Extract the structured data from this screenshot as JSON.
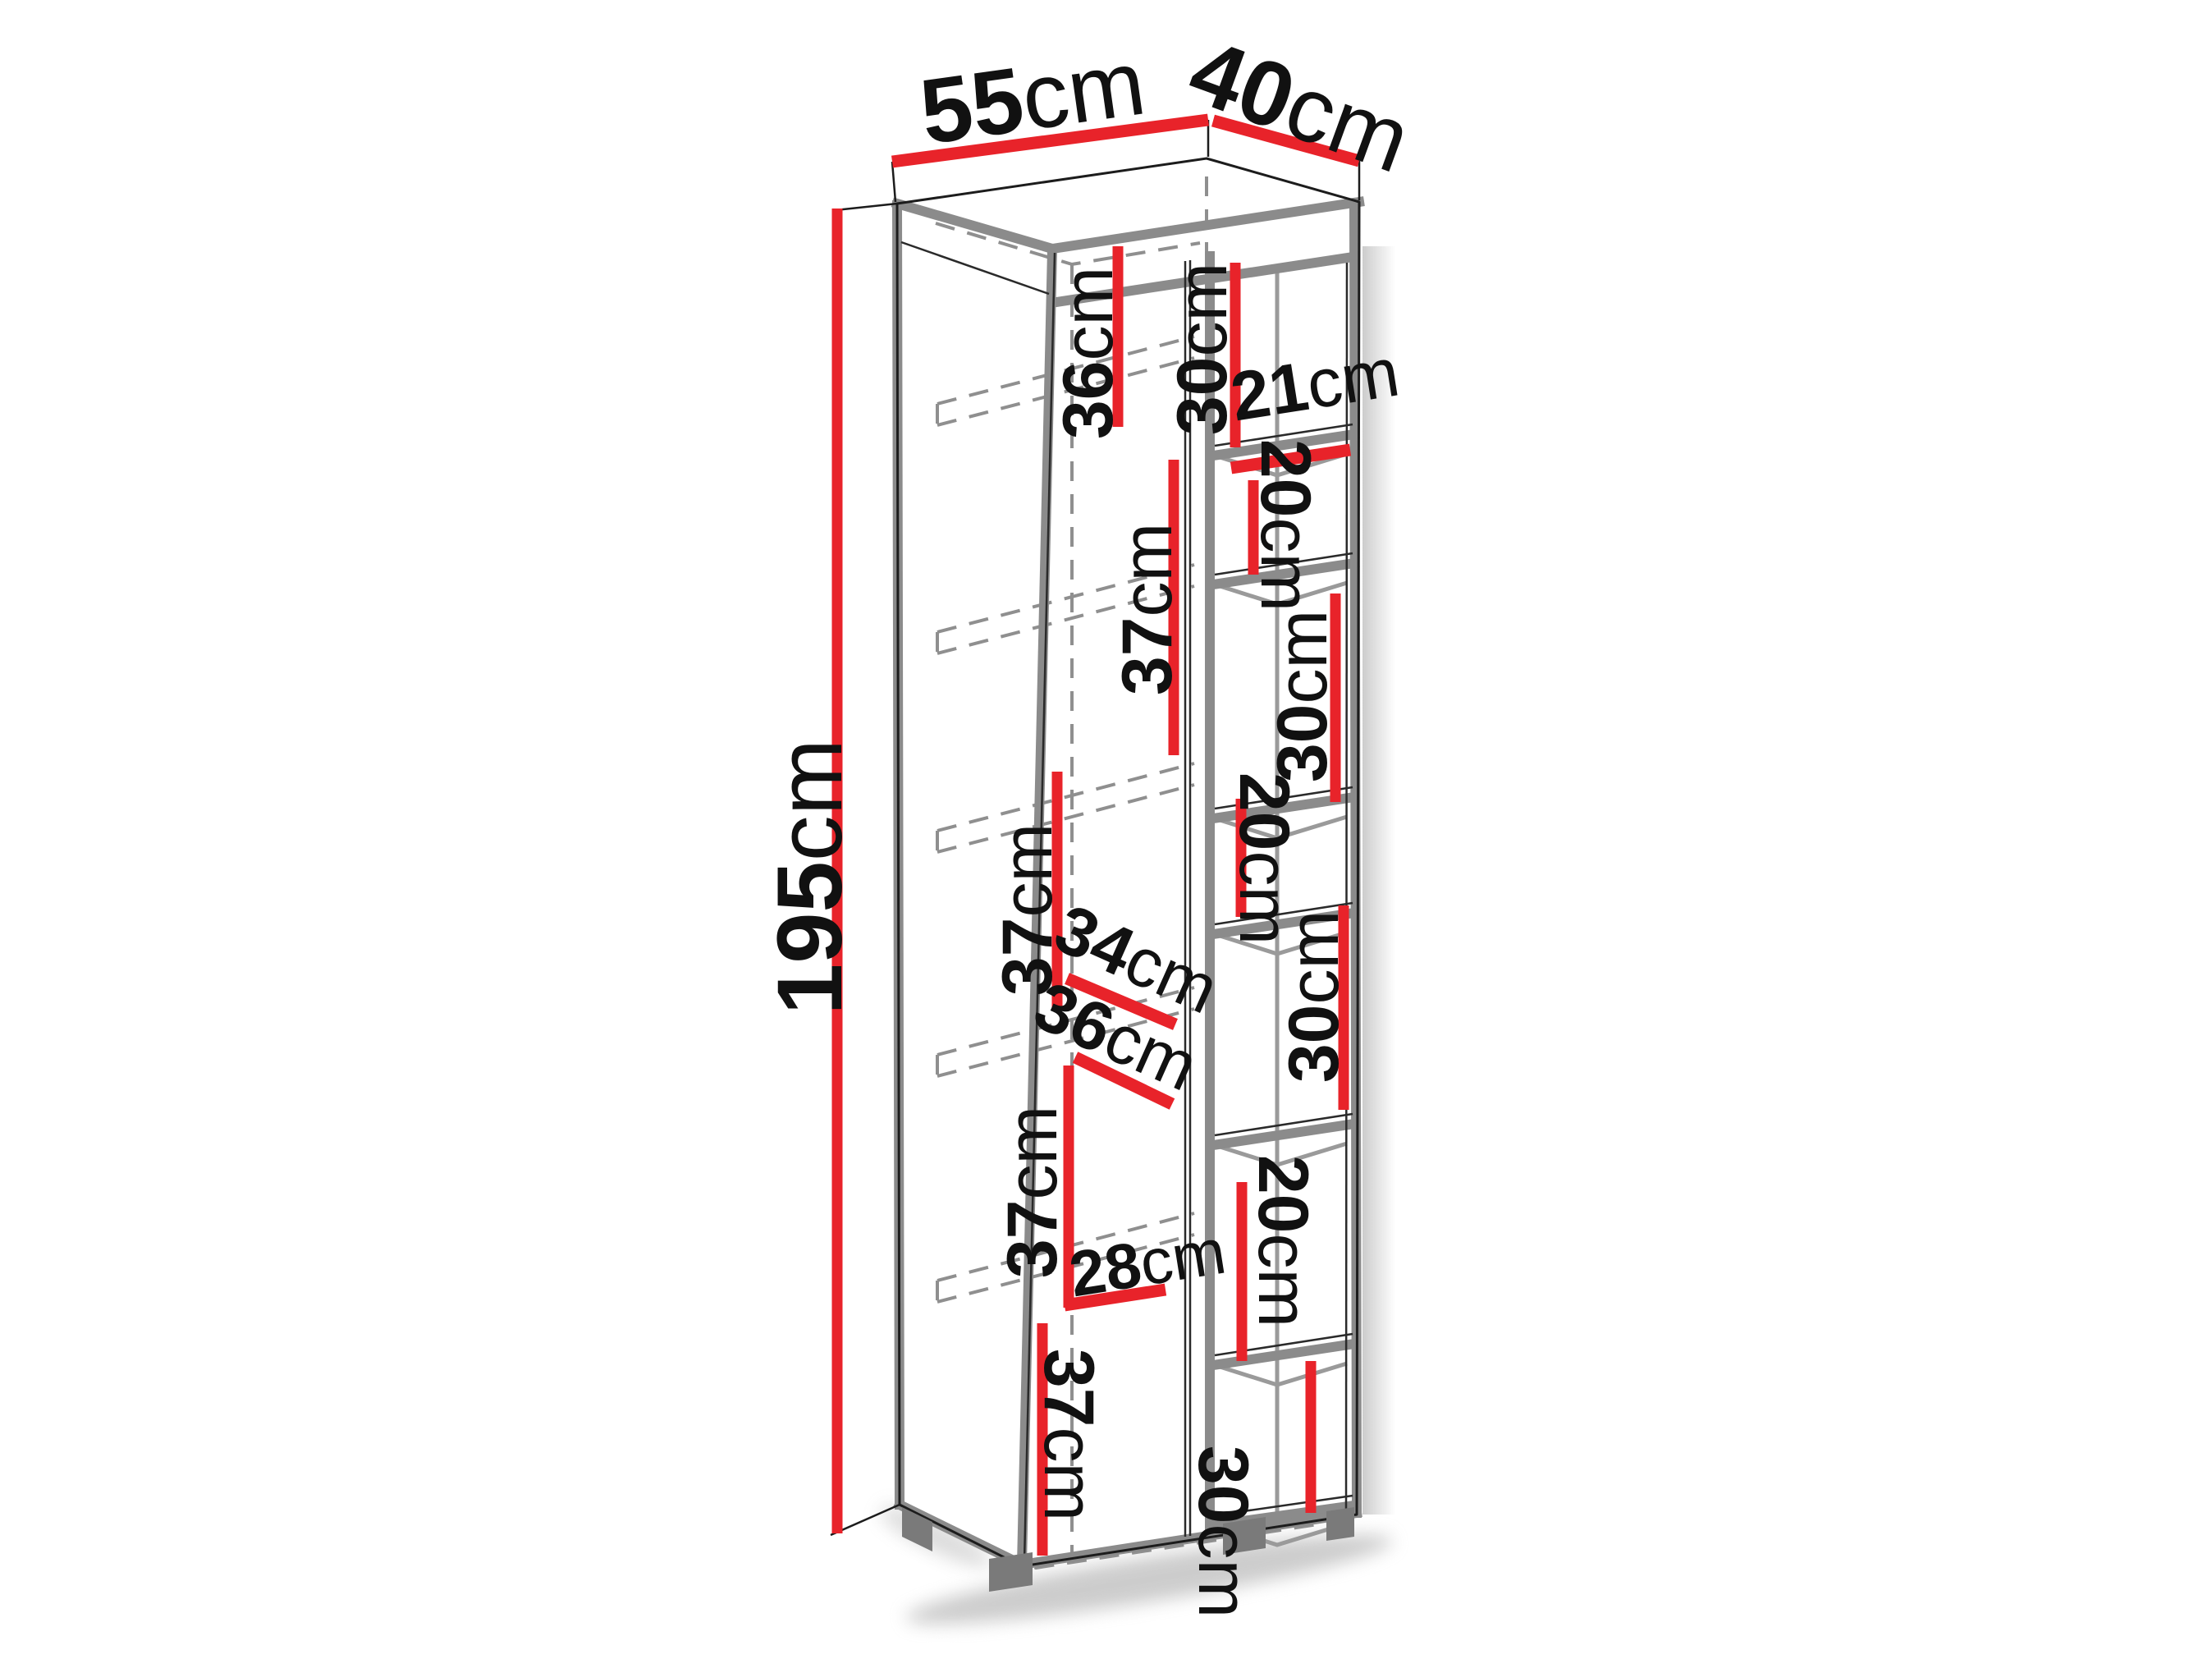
{
  "diagram": {
    "type": "furniture-dimension-drawing",
    "item": "tall-cabinet-with-open-side-shelves",
    "unit": "cm",
    "overall": {
      "width_top": {
        "v": "55",
        "u": "cm"
      },
      "depth_top": {
        "v": "40",
        "u": "cm"
      },
      "height": {
        "v": "195",
        "u": "cm"
      }
    },
    "left_column": {
      "compartment_heights": [
        {
          "v": "36",
          "u": "cm"
        },
        {
          "v": "37",
          "u": "cm"
        },
        {
          "v": "37",
          "u": "cm"
        },
        {
          "v": "37",
          "u": "cm"
        },
        {
          "v": "37",
          "u": "cm"
        }
      ],
      "diag_mid": {
        "v": "34",
        "u": "cm"
      },
      "diag_low": {
        "v": "28",
        "u": "cm"
      }
    },
    "right_column": {
      "compartment_heights": [
        {
          "v": "30",
          "u": "cm"
        },
        {
          "v": "20",
          "u": "cm"
        },
        {
          "v": "30",
          "u": "cm"
        },
        {
          "v": "20",
          "u": "cm"
        },
        {
          "v": "30",
          "u": "cm"
        },
        {
          "v": "20",
          "u": "cm"
        },
        {
          "v": "30",
          "u": "cm"
        }
      ],
      "diag_top": {
        "v": "21",
        "u": "cm"
      },
      "diag_mid": {
        "v": "36",
        "u": "cm"
      }
    },
    "colors": {
      "dimension_red": "#e8232a",
      "structure_gray": "#8b8b8b",
      "hidden_line_gray": "#8f8f8f",
      "outline_black": "#1c1c1c",
      "background": "#ffffff"
    }
  }
}
